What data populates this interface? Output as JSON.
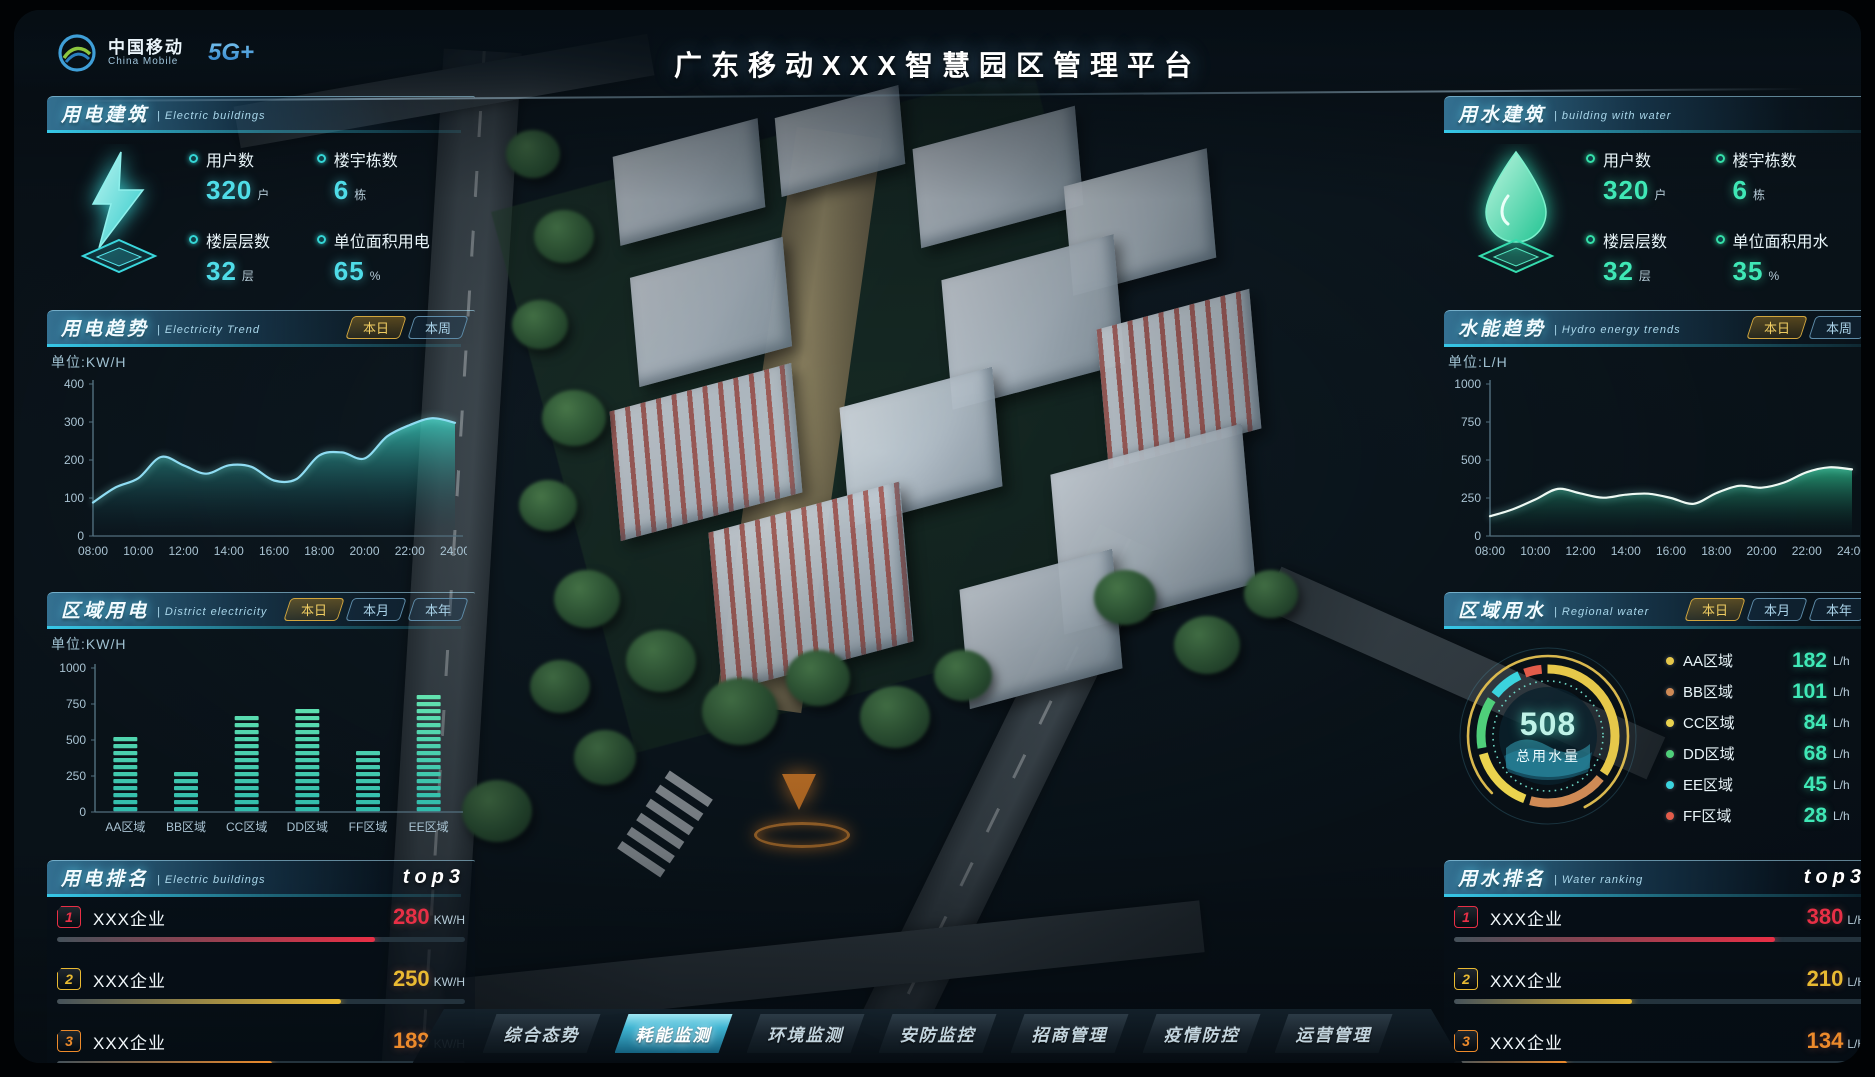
{
  "header": {
    "brand": {
      "name_cn": "中国移动",
      "name_en": "China Mobile",
      "badge": "5G+"
    },
    "title": "广东移动XXX智慧园区管理平台"
  },
  "panels": {
    "electric_building": {
      "title": "用电建筑",
      "subtitle": "| Electric buildings",
      "stats": [
        {
          "label": "用户数",
          "value": "320",
          "unit": "户"
        },
        {
          "label": "楼宇栋数",
          "value": "6",
          "unit": "栋"
        },
        {
          "label": "楼层层数",
          "value": "32",
          "unit": "层"
        },
        {
          "label": "单位面积用电",
          "value": "65",
          "unit": "%"
        }
      ]
    },
    "electricity_trend": {
      "title": "用电趋势",
      "subtitle": "| Electricity Trend",
      "tabs": [
        "本日",
        "本周"
      ],
      "active_tab": "本日",
      "unit_label": "单位:KW/H"
    },
    "district_electricity": {
      "title": "区域用电",
      "subtitle": "| District electricity",
      "tabs": [
        "本日",
        "本月",
        "本年"
      ],
      "active_tab": "本日",
      "unit_label": "单位:KW/H"
    },
    "electric_ranking": {
      "title": "用电排名",
      "subtitle": "| Electric buildings",
      "badge": "top3",
      "rows": [
        {
          "rank": "1",
          "name": "XXX企业",
          "value": "280",
          "unit": "KW/H"
        },
        {
          "rank": "2",
          "name": "XXX企业",
          "value": "250",
          "unit": "KW/H"
        },
        {
          "rank": "3",
          "name": "XXX企业",
          "value": "189",
          "unit": "KW/H"
        }
      ]
    },
    "water_building": {
      "title": "用水建筑",
      "subtitle": "| building with water",
      "stats": [
        {
          "label": "用户数",
          "value": "320",
          "unit": "户"
        },
        {
          "label": "楼宇栋数",
          "value": "6",
          "unit": "栋"
        },
        {
          "label": "楼层层数",
          "value": "32",
          "unit": "层"
        },
        {
          "label": "单位面积用水",
          "value": "35",
          "unit": "%"
        }
      ]
    },
    "hydro_trend": {
      "title": "水能趋势",
      "subtitle": "| Hydro energy trends",
      "tabs": [
        "本日",
        "本周"
      ],
      "active_tab": "本日",
      "unit_label": "单位:L/H"
    },
    "regional_water": {
      "title": "区域用水",
      "subtitle": "| Regional water",
      "tabs": [
        "本日",
        "本月",
        "本年"
      ],
      "active_tab": "本日",
      "gauge": {
        "value": "508",
        "label": "总用水量"
      },
      "legend": [
        {
          "name": "AA区域",
          "value": "182",
          "unit": "L/h",
          "color": "#e6c84a"
        },
        {
          "name": "BB区域",
          "value": "101",
          "unit": "L/h",
          "color": "#cf8a55"
        },
        {
          "name": "CC区域",
          "value": "84",
          "unit": "L/h",
          "color": "#ead34e"
        },
        {
          "name": "DD区域",
          "value": "68",
          "unit": "L/h",
          "color": "#4fcf7a"
        },
        {
          "name": "EE区域",
          "value": "45",
          "unit": "L/h",
          "color": "#3bd4de"
        },
        {
          "name": "FF区域",
          "value": "28",
          "unit": "L/h",
          "color": "#e25c4a"
        }
      ]
    },
    "water_ranking": {
      "title": "用水排名",
      "subtitle": "| Water ranking",
      "badge": "top3",
      "rows": [
        {
          "rank": "1",
          "name": "XXX企业",
          "value": "380",
          "unit": "L/H"
        },
        {
          "rank": "2",
          "name": "XXX企业",
          "value": "210",
          "unit": "L/H"
        },
        {
          "rank": "3",
          "name": "XXX企业",
          "value": "134",
          "unit": "L/H"
        }
      ]
    }
  },
  "nav": {
    "items": [
      "综合态势",
      "耗能监测",
      "环境监测",
      "安防监控",
      "招商管理",
      "疫情防控",
      "运营管理"
    ],
    "active": "耗能监测"
  },
  "chart_data": [
    {
      "type": "area",
      "name": "electricity_trend",
      "title": "用电趋势",
      "ylabel": "单位:KW/H",
      "ylim": [
        0,
        400
      ],
      "yticks": [
        0,
        100,
        200,
        300,
        400
      ],
      "x_ticks": [
        "08:00",
        "10:00",
        "12:00",
        "14:00",
        "16:00",
        "18:00",
        "20:00",
        "22:00",
        "24:00"
      ],
      "values": [
        88,
        128,
        152,
        208,
        186,
        164,
        186,
        182,
        146,
        150,
        212,
        220,
        204,
        262,
        292,
        310,
        298
      ]
    },
    {
      "type": "area",
      "name": "hydro_energy_trend",
      "title": "水能趋势",
      "ylabel": "单位:L/H",
      "ylim": [
        0,
        1000
      ],
      "yticks": [
        0,
        250,
        500,
        750,
        1000
      ],
      "x_ticks": [
        "08:00",
        "10:00",
        "12:00",
        "14:00",
        "16:00",
        "18:00",
        "20:00",
        "22:00",
        "24:00"
      ],
      "values": [
        130,
        175,
        240,
        310,
        280,
        252,
        272,
        278,
        250,
        212,
        282,
        330,
        318,
        352,
        420,
        452,
        438
      ]
    },
    {
      "type": "bar",
      "name": "district_electricity",
      "title": "区域用电",
      "ylabel": "单位:KW/H",
      "ylim": [
        0,
        1000
      ],
      "yticks": [
        0,
        250,
        500,
        750,
        1000
      ],
      "categories": [
        "AA区域",
        "BB区域",
        "CC区域",
        "DD区域",
        "FF区域",
        "EE区域"
      ],
      "values": [
        560,
        300,
        690,
        720,
        430,
        850
      ]
    },
    {
      "type": "pie",
      "name": "regional_water",
      "title": "区域用水",
      "labels": [
        "AA区域",
        "BB区域",
        "CC区域",
        "DD区域",
        "EE区域",
        "FF区域"
      ],
      "values": [
        182,
        101,
        84,
        68,
        45,
        28
      ],
      "center_total": 508,
      "center_label": "总用水量"
    }
  ]
}
